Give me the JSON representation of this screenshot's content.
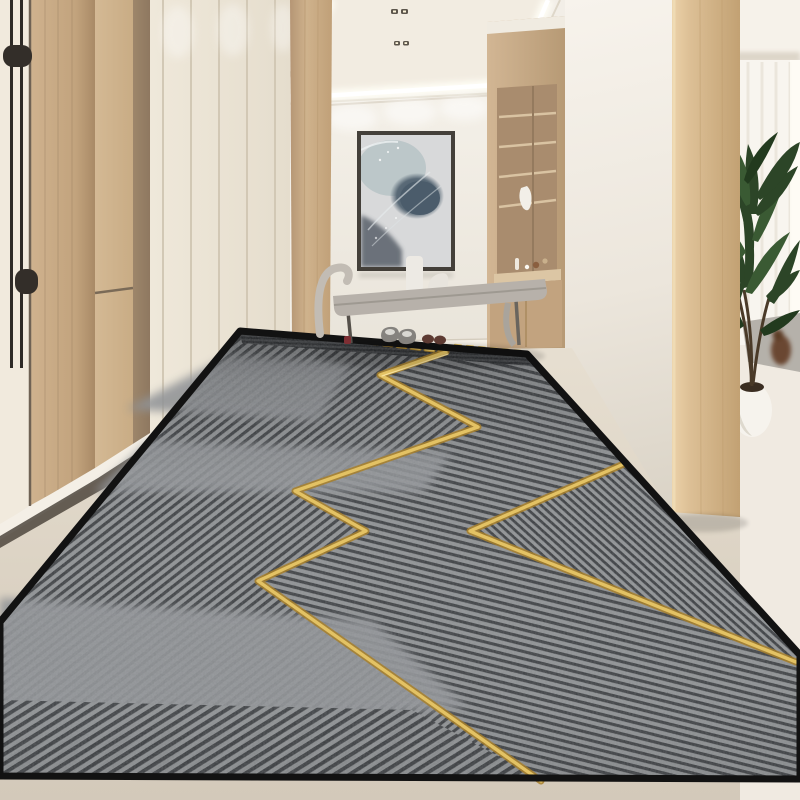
{
  "meta": {
    "kind": "photorealistic interior render, no visible text",
    "description": "Modern entryway hallway with a long grey striped runner rug featuring a gold zigzag line; cream wardrobes and wood panels on the left, abstract wall art over a grey bench with two pairs of shoes, built-in wood shelf niche, wood pillar opening to a bright room with sheer curtains and a potted palm on the right.",
    "width_px": 800,
    "height_px": 800
  },
  "palette": {
    "wall_white": "#f2eee7",
    "ceiling_white": "#f6f2ea",
    "recess_ivory": "#f2ece1",
    "cove_glow": "#fffef6",
    "cream_panel": "#ece5d7",
    "cream_door": "#f1eadd",
    "wood_light": "#d3b893",
    "wood_mid": "#c3a27e",
    "wood_dark": "#9c8266",
    "wood_pillar": "#dfc49e",
    "back_wall": "#f0ece5",
    "art_bg": "#d8d9da",
    "art_blue": "#4b5c6b",
    "bench_gray": "#b7b1aa",
    "floor_beige": "#ded6c8",
    "floor_white": "#f0eae1",
    "rug_base": "#75787a",
    "rug_stripe_dark": "#3a3d40",
    "rug_stripe_light": "#8e9193",
    "rug_plain": "#909396",
    "rug_border": "#121212",
    "gold": "#e3c264",
    "gold_deep": "#a8802a",
    "plant_green": "#2c4527",
    "plant_green_light": "#3a5a33",
    "shoe_gray": "#85827e",
    "shoe_brown": "#5d3a32",
    "handle_black": "#2e2a26",
    "curtain": "#f8f5ef",
    "shadow_strip": "#4f473d"
  },
  "scene": {
    "objects": {
      "ceiling": {
        "label": "recessed tray ceiling with LED cove lighting and two pairs of spotlights"
      },
      "entry_door": {
        "label": "cream entry door with long black pull handle"
      },
      "wood_panels": {
        "label": "light oak wood wall panels and concealed door"
      },
      "wardrobe": {
        "label": "cream full-height wardrobe with five vertical panel seams"
      },
      "pilaster": {
        "label": "oak wood pilaster at hallway corner"
      },
      "artwork": {
        "label": "abstract blue-grey framed artwork on back wall"
      },
      "bench": {
        "label": "grey upholstered bench with sculpted arm, white vase and decor"
      },
      "shoes_grey": {
        "label": "pair of grey shoes on rug edge"
      },
      "shoes_brown": {
        "label": "pair of dark brown shoes on rug edge"
      },
      "shelf_niche": {
        "label": "built-in wood shelf niche with decor objects"
      },
      "white_pillar": {
        "label": "white wall face beside opening"
      },
      "wood_pillar": {
        "label": "oak wood pillar framing opening to side room"
      },
      "curtains": {
        "label": "sheer white curtains in bright side room"
      },
      "palm_plant": {
        "label": "potted palm plant in white round planter"
      },
      "side_rug": {
        "label": "small grey rug with brown ornament in side room"
      },
      "runner_rug": {
        "label": "long grey striped runner rug with black border"
      },
      "gold_zigzag": {
        "label": "metallic gold zigzag lines across the rug"
      },
      "floor": {
        "label": "beige and white stone floor"
      }
    },
    "counts": {
      "shoe_pairs": 2,
      "wardrobe_seams": 5,
      "ceiling_spotlight_fixtures": 2
    }
  }
}
